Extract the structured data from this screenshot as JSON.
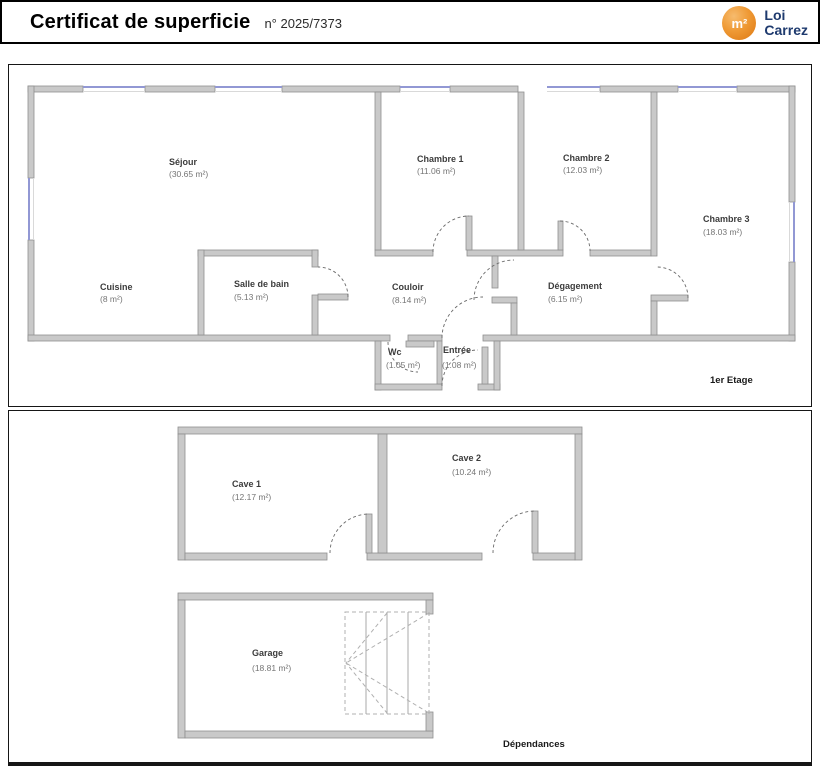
{
  "header": {
    "title": "Certificat de superficie",
    "number": "n° 2025/7373",
    "logo": {
      "symbol": "m²",
      "line1": "Loi",
      "line2": "Carrez"
    }
  },
  "colors": {
    "wall": "#c9c9c9",
    "wall_outline": "#8f8f8f",
    "window": "#9298d4",
    "logo_orange": "#e8821c",
    "logo_navy": "#1e3a6e"
  },
  "floor1": {
    "caption": "1er Etage",
    "rooms": {
      "sejour": {
        "name": "Séjour",
        "area": "(30.65 m²)"
      },
      "cuisine": {
        "name": "Cuisine",
        "area": "(8 m²)"
      },
      "sdb": {
        "name": "Salle de bain",
        "area": "(5.13 m²)"
      },
      "chambre1": {
        "name": "Chambre 1",
        "area": "(11.06 m²)"
      },
      "chambre2": {
        "name": "Chambre 2",
        "area": "(12.03 m²)"
      },
      "chambre3": {
        "name": "Chambre 3",
        "area": "(18.03 m²)"
      },
      "couloir": {
        "name": "Couloir",
        "area": "(8.14 m²)"
      },
      "degagement": {
        "name": "Dégagement",
        "area": "(6.15 m²)"
      },
      "wc": {
        "name": "Wc",
        "area": "(1.05 m²)"
      },
      "entree": {
        "name": "Entrée",
        "area": "(1.08 m²)"
      }
    }
  },
  "floor2": {
    "caption": "Dépendances",
    "rooms": {
      "cave1": {
        "name": "Cave 1",
        "area": "(12.17 m²)"
      },
      "cave2": {
        "name": "Cave 2",
        "area": "(10.24 m²)"
      },
      "garage": {
        "name": "Garage",
        "area": "(18.81 m²)"
      }
    }
  }
}
